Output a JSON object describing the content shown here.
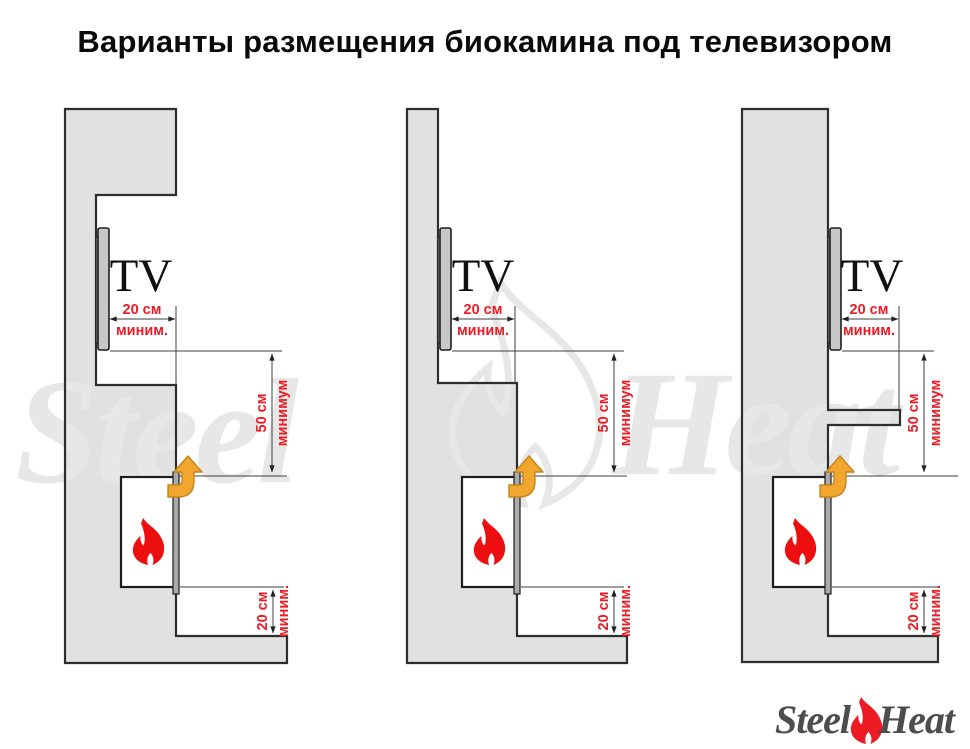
{
  "title": "Варианты размещения биокамина под телевизором",
  "watermark": {
    "word1": "Steel",
    "word2": "Heat"
  },
  "logo": {
    "word1": "Steel",
    "word2": "Heat"
  },
  "colors": {
    "dimension_red": "#ED1C24",
    "flame_red": "#ED0F0F",
    "airflow_orange": "#F1A62E",
    "airflow_orange_outline": "#C5851D",
    "wall_gray": "#E1E1E1",
    "outline_dark": "#2E2E2E",
    "watermark_gray": "#E7E7E7"
  },
  "diagrams": [
    {
      "name": "tv-in-niche-variant",
      "tv_label": "TV",
      "dim_tv_depth": {
        "value": "20 см",
        "qualifier": "миним."
      },
      "dim_tv_to_fireplace": {
        "value": "50 см",
        "qualifier": "минимум"
      },
      "dim_fireplace_to_base": {
        "value": "20 см",
        "qualifier": "миним."
      }
    },
    {
      "name": "chimney-breast-below-variant",
      "tv_label": "TV",
      "dim_tv_depth": {
        "value": "20 см",
        "qualifier": "миним."
      },
      "dim_tv_to_fireplace": {
        "value": "50 см",
        "qualifier": "минимум"
      },
      "dim_fireplace_to_base": {
        "value": "20 см",
        "qualifier": "миним."
      }
    },
    {
      "name": "shelf-between-variant",
      "tv_label": "TV",
      "dim_tv_depth": {
        "value": "20 см",
        "qualifier": "миним."
      },
      "dim_tv_to_fireplace": {
        "value": "50 см",
        "qualifier": "минимум"
      },
      "dim_fireplace_to_base": {
        "value": "20 см",
        "qualifier": "миним."
      }
    }
  ]
}
